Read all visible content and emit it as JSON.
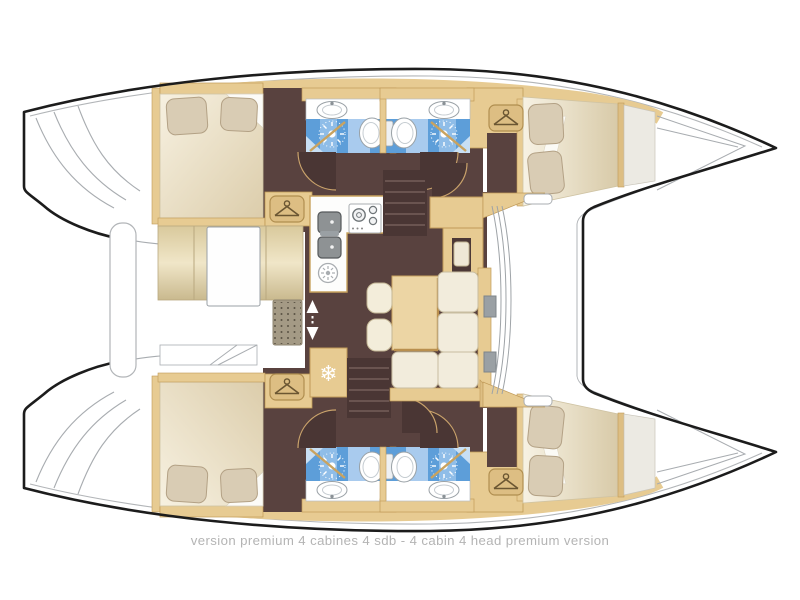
{
  "caption": {
    "text": "version premium 4 cabines 4 sdb - 4 cabin 4 head premium version"
  },
  "colors": {
    "hull_outline": "#1c1c1c",
    "deck_line_grey": "#a8acb0",
    "wood": "#e7cb92",
    "wood_dark": "#c09a58",
    "floor_brown": "#59423f",
    "stair_brown": "#4a3634",
    "bathroom_blue": "#5d9ed9",
    "bathroom_blue_light": "#8fbde8",
    "mattress_cream": "#f3ecd9",
    "pillow_beige": "#d9ccb4",
    "sofa_cream": "#f2ecdc",
    "caption_grey": "#b4b4b4"
  },
  "icons": {
    "hanger-icon": {
      "glyph": "hanger",
      "count": 4
    },
    "snowflake-icon": {
      "glyph": "❄",
      "count": 1
    },
    "shower-spray-icon": {
      "glyph": "✳",
      "count": 4
    },
    "door-arrows-icon": {
      "glyph": "▲▼",
      "count": 1
    }
  }
}
